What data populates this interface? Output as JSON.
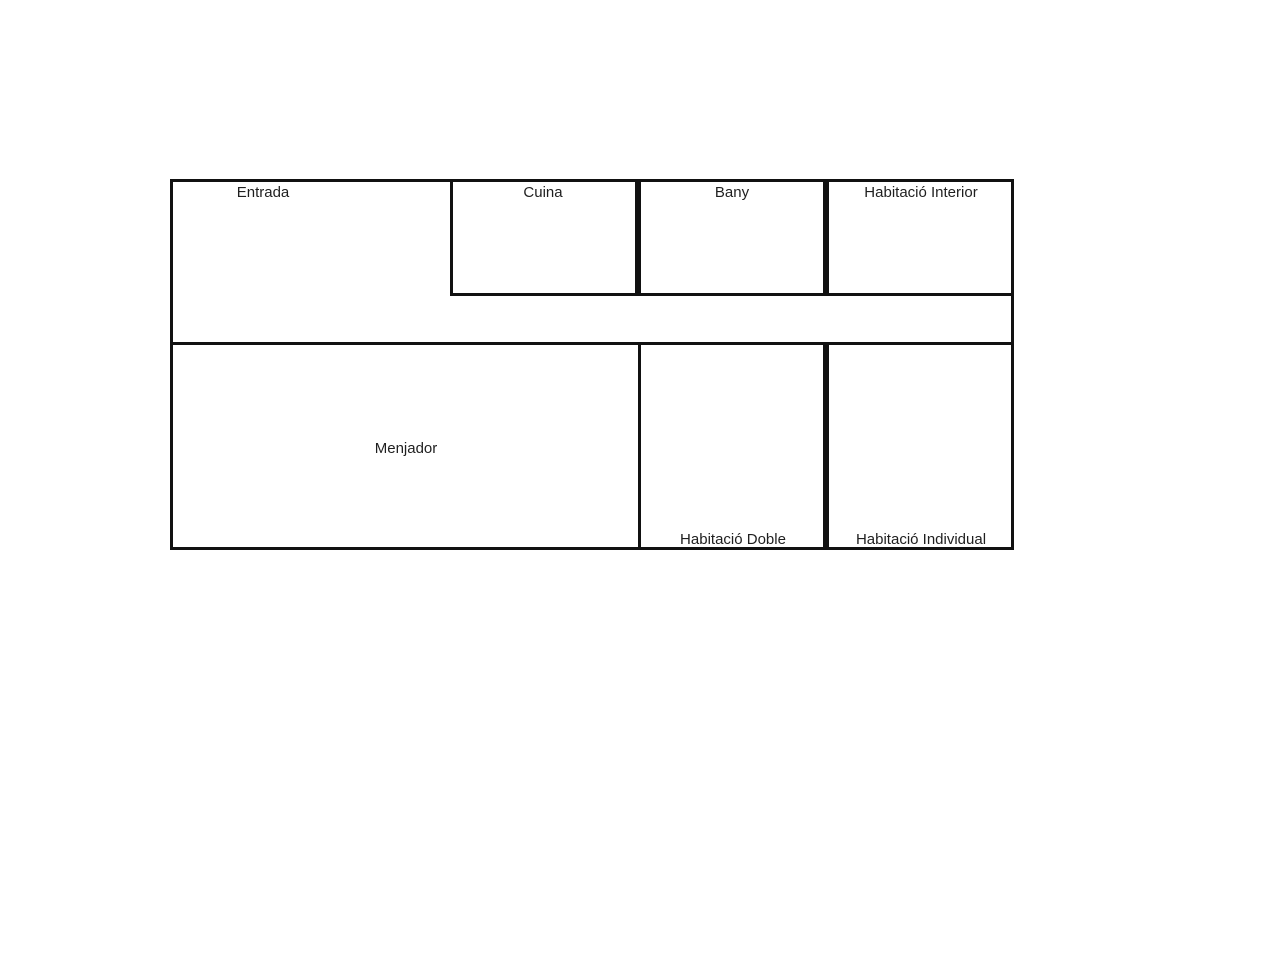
{
  "colors": {
    "wall": "#111111",
    "background": "#ffffff",
    "text": "#1f1f1f"
  },
  "floor_plan": {
    "rooms": [
      {
        "id": "entrada",
        "label": "Entrada"
      },
      {
        "id": "cuina",
        "label": "Cuina"
      },
      {
        "id": "bany",
        "label": "Bany"
      },
      {
        "id": "habitacio-interior",
        "label": "Habitació Interior"
      },
      {
        "id": "menjador",
        "label": "Menjador"
      },
      {
        "id": "habitacio-doble",
        "label": "Habitació Doble"
      },
      {
        "id": "habitacio-individual",
        "label": "Habitació Individual"
      }
    ]
  }
}
